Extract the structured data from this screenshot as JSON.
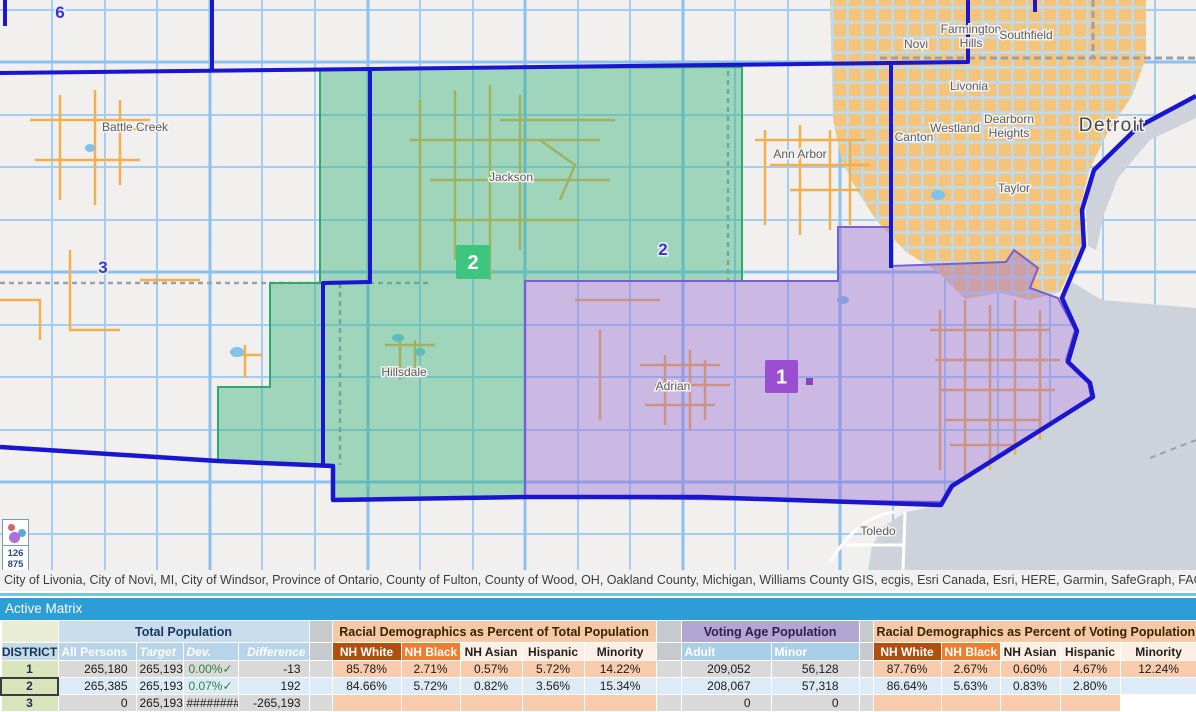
{
  "map": {
    "attribution": "City of Livonia, City of Novi, MI, City of Windsor, Province of Ontario, County of Fulton, County of Wood, OH, Oakland County, Michigan, Williams County GIS, ecgis, Esri Canada, Esri, HERE, Garmin, SafeGraph, FAO, METI/",
    "city_labels": [
      {
        "text": "Battle Creek",
        "x": 135,
        "y": 131,
        "size": "normal"
      },
      {
        "text": "Jackson",
        "x": 511,
        "y": 181,
        "size": "normal"
      },
      {
        "text": "Ann Arbor",
        "x": 800,
        "y": 158,
        "size": "normal"
      },
      {
        "text": "Hillsdale",
        "x": 404,
        "y": 376,
        "size": "normal"
      },
      {
        "text": "Adrian",
        "x": 673,
        "y": 390,
        "size": "normal"
      },
      {
        "text": "Toledo",
        "x": 878,
        "y": 535,
        "size": "normal"
      },
      {
        "text": "Novi",
        "x": 916,
        "y": 48,
        "size": "normal"
      },
      {
        "text": "Farmington",
        "x": 971,
        "y": 33,
        "size": "normal"
      },
      {
        "text": "Hills",
        "x": 971,
        "y": 47,
        "size": "normal"
      },
      {
        "text": "Southfield",
        "x": 1026,
        "y": 39,
        "size": "normal"
      },
      {
        "text": "Livonia",
        "x": 969,
        "y": 90,
        "size": "normal"
      },
      {
        "text": "Westland",
        "x": 955,
        "y": 132,
        "size": "normal"
      },
      {
        "text": "Canton",
        "x": 914,
        "y": 141,
        "size": "normal"
      },
      {
        "text": "Dearborn",
        "x": 1009,
        "y": 123,
        "size": "normal"
      },
      {
        "text": "Heights",
        "x": 1009,
        "y": 137,
        "size": "normal"
      },
      {
        "text": "Taylor",
        "x": 1014,
        "y": 192,
        "size": "normal"
      },
      {
        "text": "Detroit",
        "x": 1112,
        "y": 131,
        "size": "big"
      }
    ],
    "district_labels": [
      {
        "text": "6",
        "x": 60,
        "y": 18
      },
      {
        "text": "3",
        "x": 103,
        "y": 273
      },
      {
        "text": "2",
        "x": 663,
        "y": 255
      }
    ],
    "district_markers": [
      {
        "text": "2",
        "x": 456,
        "y": 245,
        "w": 34,
        "color": "#3ec57e"
      },
      {
        "text": "1",
        "x": 765,
        "y": 360,
        "w": 33,
        "color": "#9b4fd0"
      }
    ],
    "cluster_widget": {
      "values": [
        "126",
        "875"
      ]
    },
    "colors": {
      "district1_fill": "#c8b4e8",
      "district2_fill": "#9ed7b8",
      "boundary": "#1a15cf",
      "urban": "#f6c478",
      "water": "#cdd2db"
    }
  },
  "matrix": {
    "title": "Active Matrix",
    "district_header": "DISTRICT",
    "sections": [
      {
        "id": "total",
        "title": "Total Population",
        "style": "blue",
        "columns": [
          {
            "label": "All Persons",
            "style": "h-blue"
          },
          {
            "label": "Target",
            "style": "h-blue it"
          },
          {
            "label": "Dev.",
            "style": "h-blue it"
          },
          {
            "label": "Difference",
            "style": "h-blue it right"
          }
        ]
      },
      {
        "id": "racial_total",
        "title": "Racial Demographics as Percent of  Total Population",
        "style": "orange",
        "columns": [
          {
            "label": "NH White",
            "style": "h-darkorange"
          },
          {
            "label": "NH Black",
            "style": "h-orange"
          },
          {
            "label": "NH Asian",
            "style": "h-light"
          },
          {
            "label": "Hispanic",
            "style": "h-light"
          },
          {
            "label": "Minority",
            "style": "h-light"
          }
        ]
      },
      {
        "id": "vap",
        "title": "Voting Age Population",
        "style": "purple",
        "columns": [
          {
            "label": "Adult",
            "style": "h-blue2"
          },
          {
            "label": "Minor",
            "style": "h-blue2"
          }
        ]
      },
      {
        "id": "racial_vap",
        "title": "Racial Demographics as Percent of  Voting Population",
        "style": "orange",
        "columns": [
          {
            "label": "NH White",
            "style": "h-darkorange"
          },
          {
            "label": "NH Black",
            "style": "h-orange"
          },
          {
            "label": "NH Asian",
            "style": "h-light"
          },
          {
            "label": "Hispanic",
            "style": "h-light"
          },
          {
            "label": "Minority",
            "style": "h-light"
          }
        ]
      }
    ],
    "rows": [
      {
        "district": "1",
        "selected": false,
        "total": [
          "265,180",
          "265,193",
          "0.00%✓",
          "-13"
        ],
        "racial_total": [
          "85.78%",
          "2.71%",
          "0.57%",
          "5.72%",
          "14.22%"
        ],
        "vap": [
          "209,052",
          "56,128"
        ],
        "racial_vap": [
          "87.76%",
          "2.67%",
          "0.60%",
          "4.67%",
          "12.24%"
        ]
      },
      {
        "district": "2",
        "selected": true,
        "total": [
          "265,385",
          "265,193",
          "0.07%✓",
          "192"
        ],
        "racial_total": [
          "84.66%",
          "5.72%",
          "0.82%",
          "3.56%",
          "15.34%"
        ],
        "vap": [
          "208,067",
          "57,318"
        ],
        "racial_vap": [
          "86.64%",
          "5.63%",
          "0.83%",
          "2.80%",
          ""
        ]
      },
      {
        "district": "3",
        "selected": false,
        "total": [
          "0",
          "265,193",
          "########",
          "-265,193"
        ],
        "racial_total": [
          "",
          "",
          "",
          "",
          ""
        ],
        "vap": [
          "0",
          "0"
        ],
        "racial_vap": [
          "",
          "",
          "",
          "",
          null
        ]
      }
    ]
  }
}
